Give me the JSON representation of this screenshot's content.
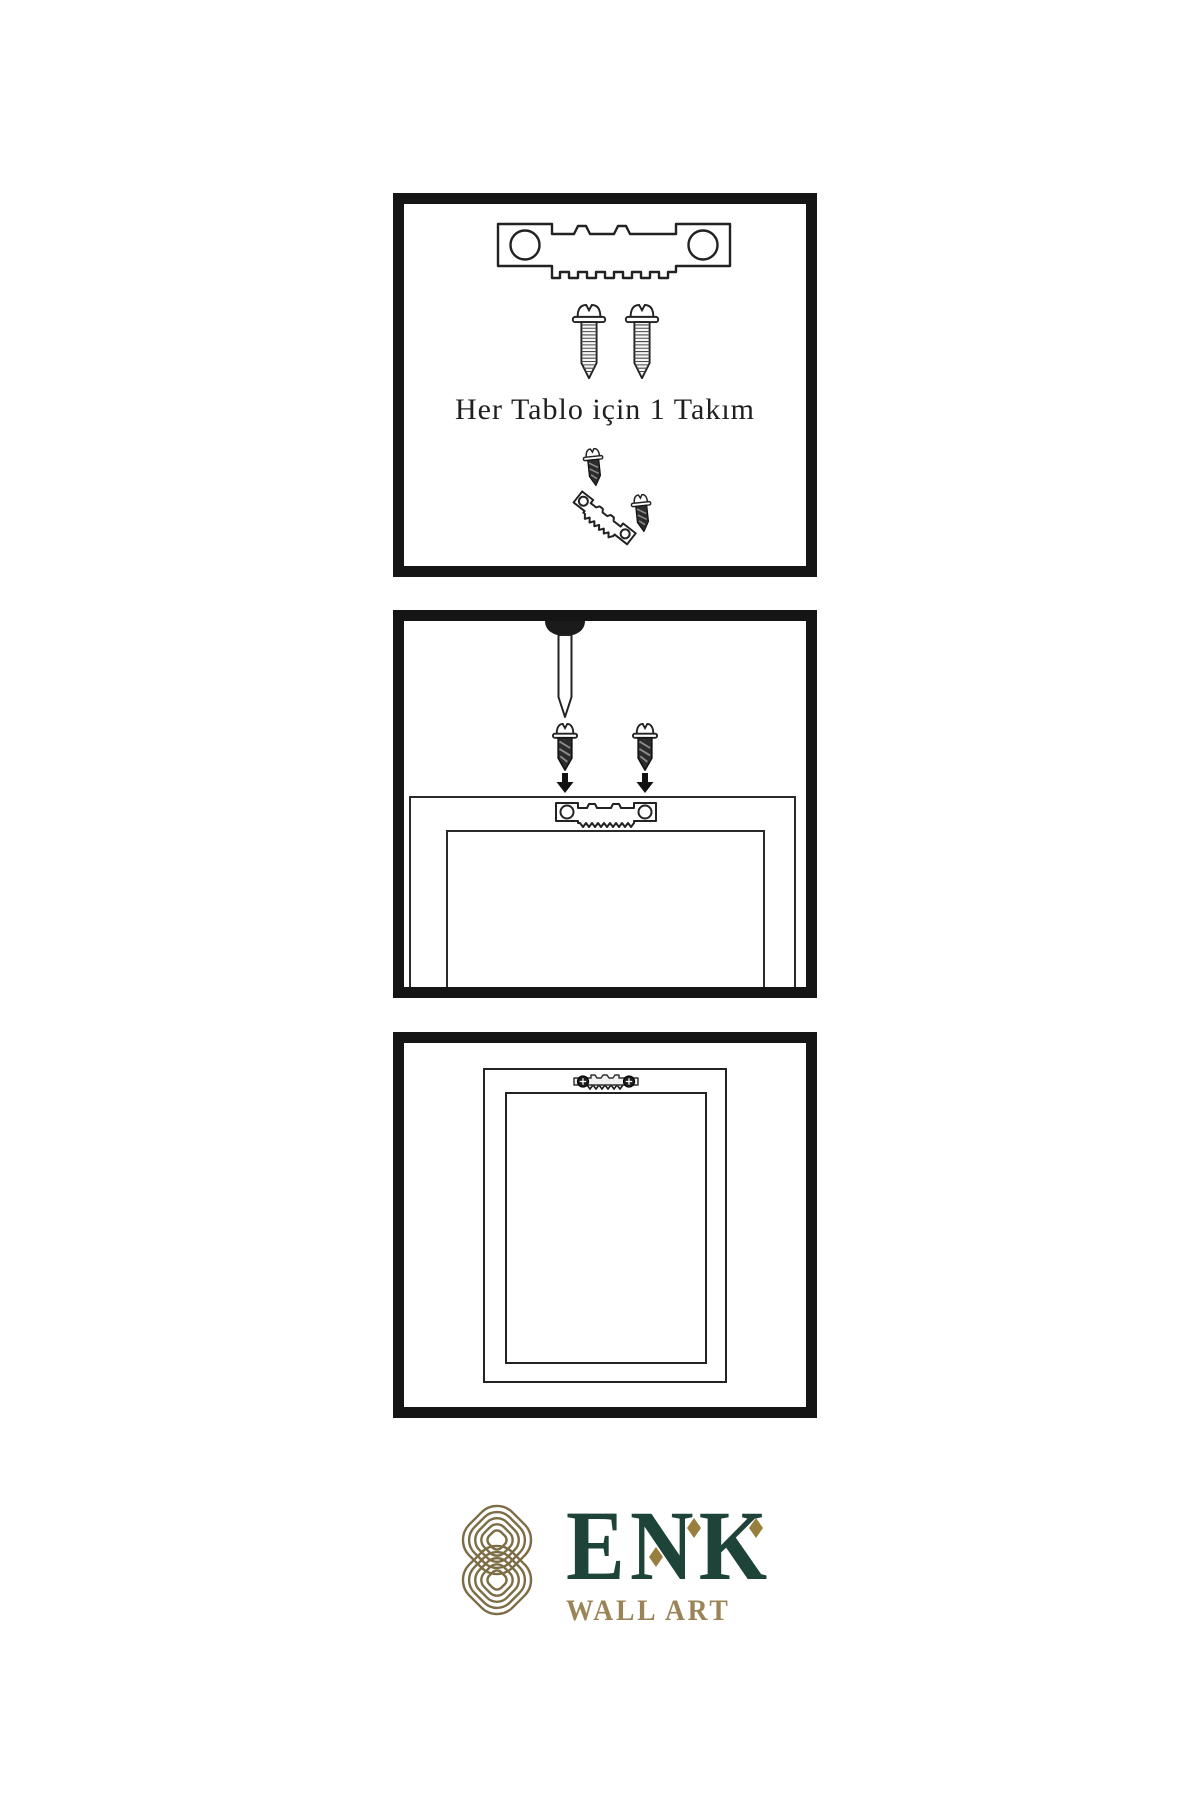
{
  "page": {
    "background": "#ffffff",
    "language": "tr"
  },
  "colors": {
    "ink": "#1c1c1c",
    "panel_border": "#151515",
    "logo_green": "#1e4338",
    "logo_gold": "#97803d",
    "knot_gold": "#7c6d45",
    "wall_art_gold": "#9b8455"
  },
  "panels": [
    {
      "id": "step-1",
      "caption": "Her Tablo için 1 Takım",
      "icons": [
        "sawtooth-hanger-icon",
        "screw-icon",
        "screw-icon",
        "screw-into-hanger-icon"
      ]
    },
    {
      "id": "step-2",
      "icons": [
        "wall-nail-icon",
        "screw-down-icon",
        "down-arrow-icon",
        "screw-down-icon",
        "down-arrow-icon",
        "frame-back-icon",
        "sawtooth-hanger-icon"
      ]
    },
    {
      "id": "step-3",
      "icons": [
        "hanging-frame-icon",
        "mounted-hanger-icon"
      ]
    }
  ],
  "logo": {
    "brand": "ENK",
    "subtitle": "WALL ART",
    "mark": "interlocked-knot-icon",
    "accents": [
      "diamond-icon",
      "diamond-icon",
      "diamond-icon"
    ]
  }
}
